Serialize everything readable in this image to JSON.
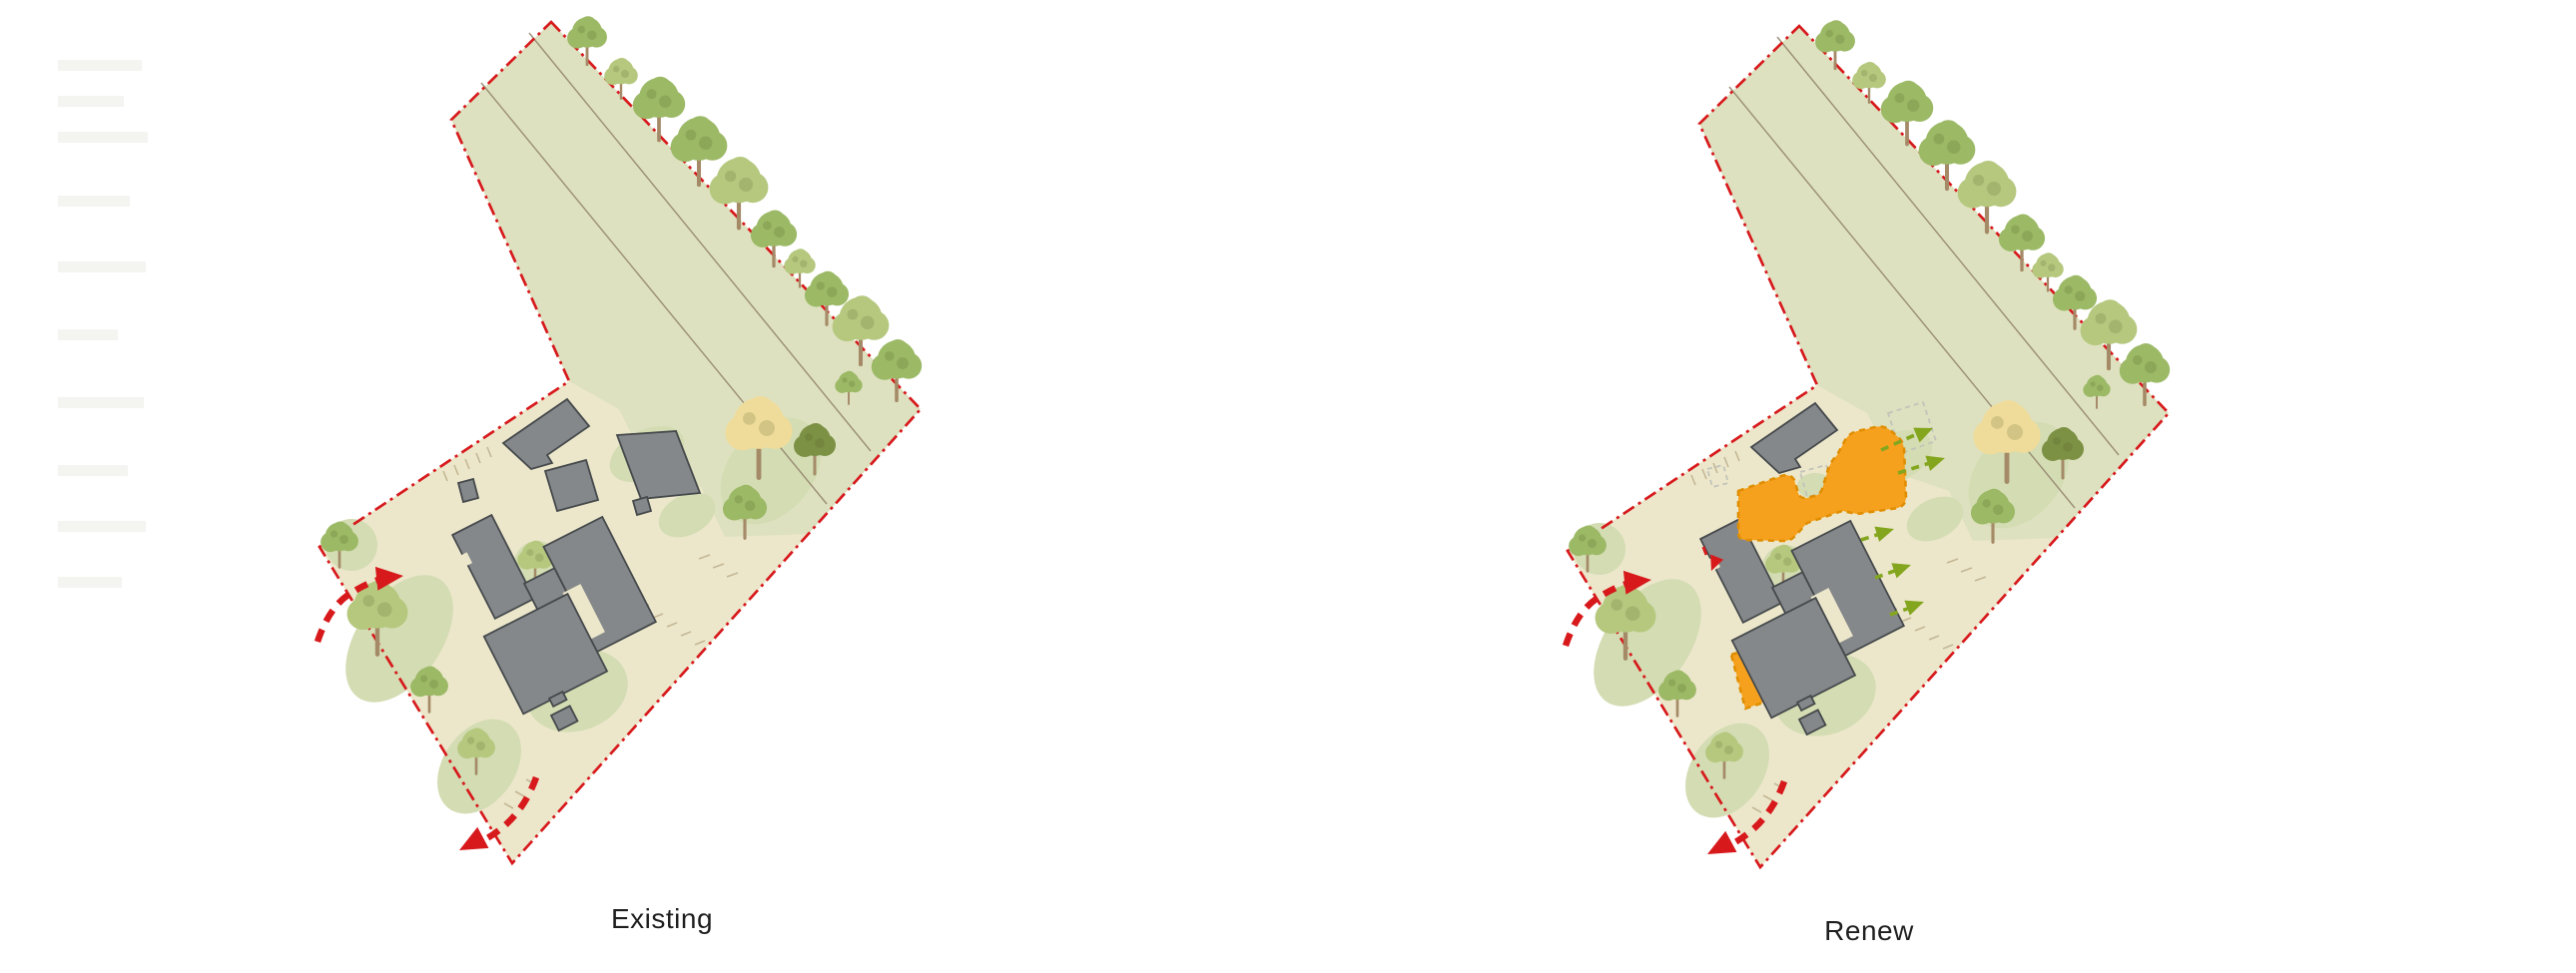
{
  "panels": [
    {
      "id": "existing",
      "label": "Existing"
    },
    {
      "id": "renew",
      "label": "Renew"
    }
  ],
  "palette": {
    "page-bg": "#ffffff",
    "field": "#dde1bf",
    "yard": "#ece7cb",
    "grass": "#d3dcb2",
    "building": "#85888a",
    "building-line": "#45494b",
    "proposed-orange": "#f6a11e",
    "proposed-orange-line": "#e08e00",
    "boundary-red": "#d7191c",
    "ghost": "#c2c4ba",
    "track": "#9b8e76",
    "view-green": "#84a61f",
    "tree-light": "#b5c87e",
    "tree-medium": "#9cb966",
    "tree-dark": "#7d9145",
    "tree-yellow": "#f0dc9a",
    "trunk": "#a58a68",
    "tick": "#c4b795",
    "label-text": "#1f1f1f"
  }
}
